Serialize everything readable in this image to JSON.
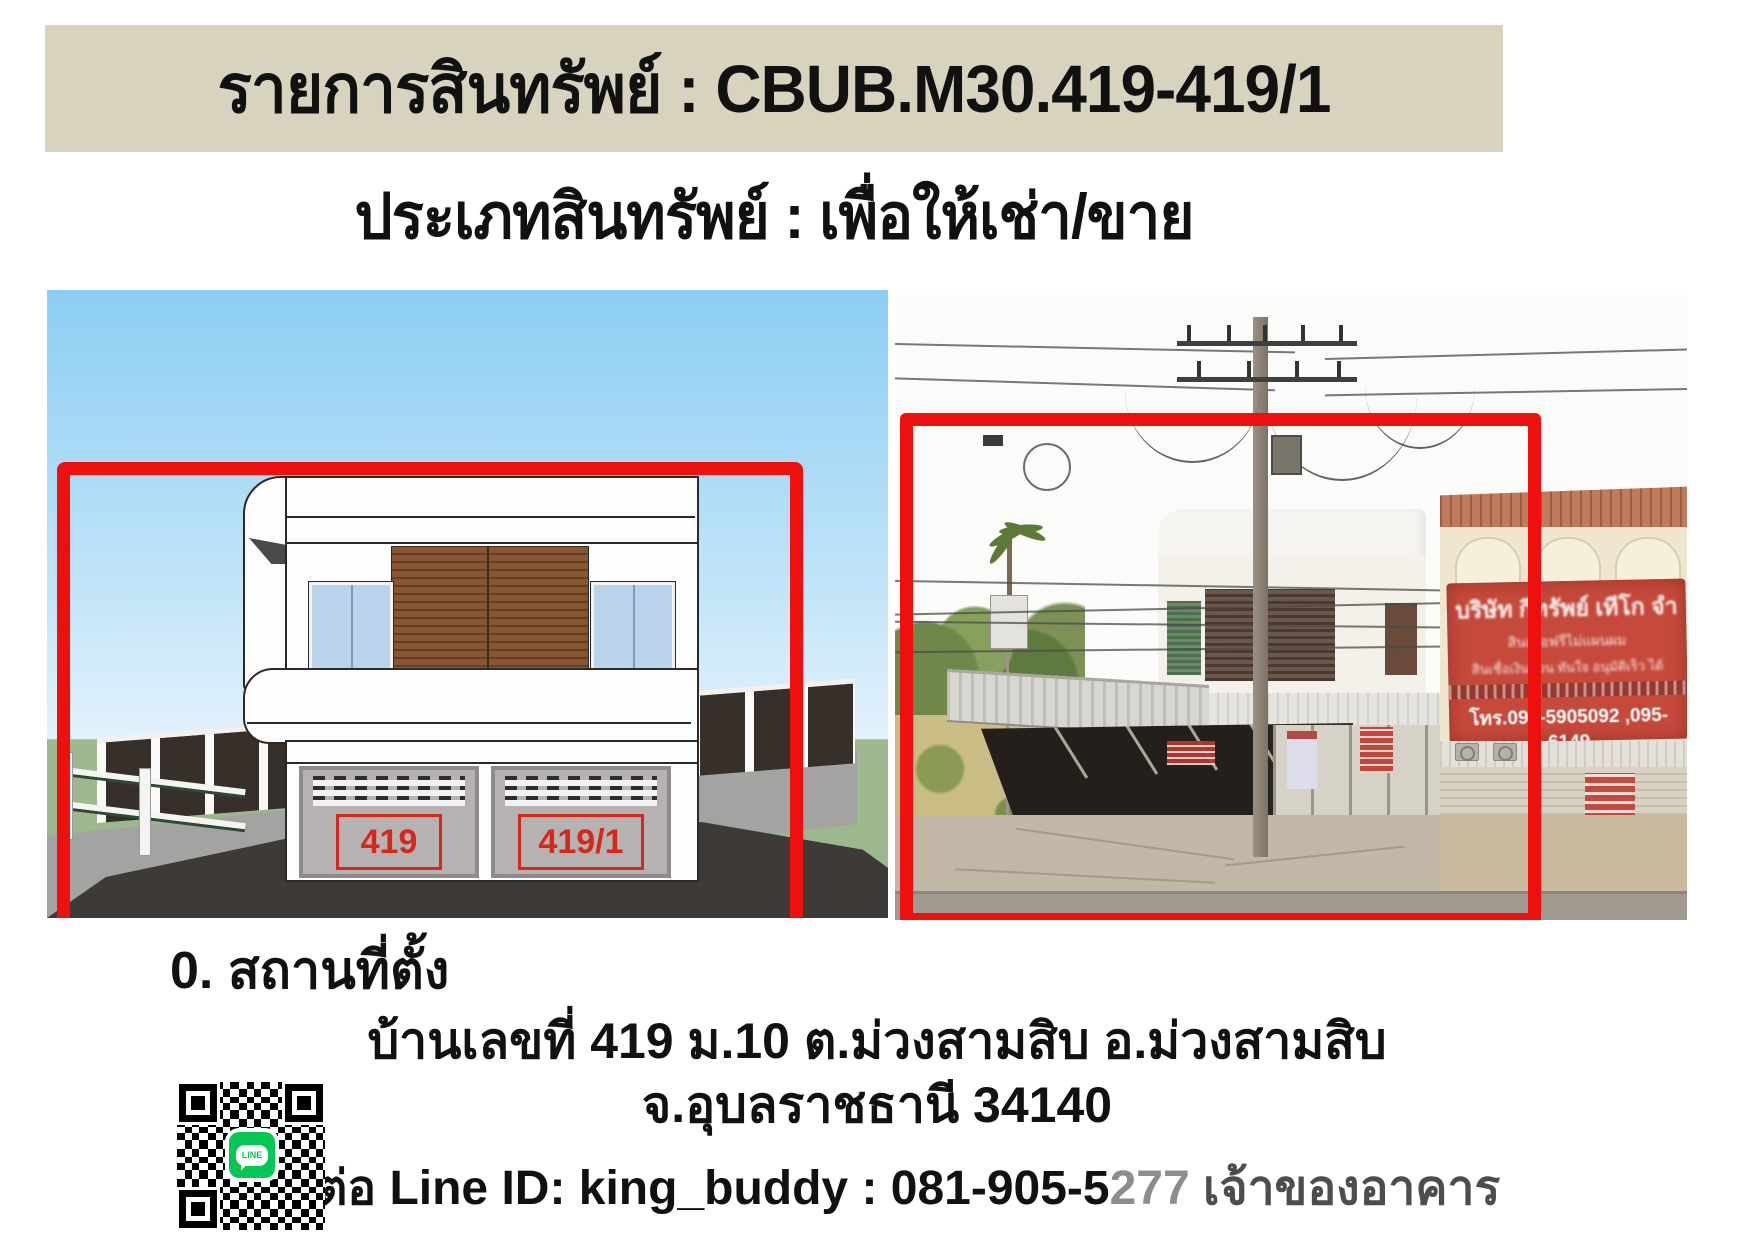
{
  "banner": {
    "title": "รายการสินทรัพย์ : CBUB.M30.419-419/1",
    "bg_color": "#d8d3bf"
  },
  "subtitle": "ประเภทสินทรัพย์ : เพื่อให้เช่า/ขาย",
  "render": {
    "door_labels": [
      "419",
      "419/1"
    ],
    "frame_color": "#ee0f0f"
  },
  "photo": {
    "frame_color": "#ee0f0f",
    "neighbor_sign": {
      "line1": "บริษัท กีทรัพย์ เทีโก จำ",
      "line2": "สินเชื่อฟรีไม่แผนผม",
      "line3": "สินเชื่อเงินด่วน ทันใจ อนุมัติเร็ว ได้",
      "phone": "โทร.094-5905092 ,095-6149"
    }
  },
  "location": {
    "heading": "0. สถานที่ตั้ง",
    "address_line1": "บ้านเลขที่ 419 ม.10 ต.ม่วงสามสิบ อ.ม่วงสามสิบ",
    "address_line2": "จ.อุบลราชธานี 34140"
  },
  "contact": {
    "prefix": "ติดต่อ Line ID: king_buddy : 081-905-5",
    "gray_digits": "277",
    "suffix": " เจ้าของอาคาร"
  },
  "qr": {
    "badge_label": "LINE",
    "badge_color": "#06C755"
  }
}
